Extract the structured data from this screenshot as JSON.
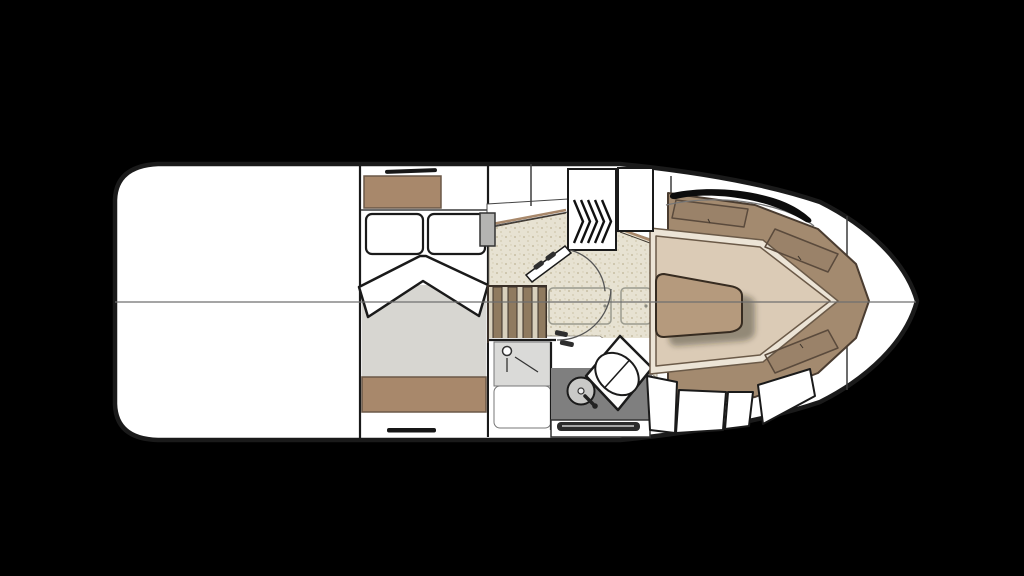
{
  "page": {
    "background": "#000000"
  },
  "palette": {
    "bg": "#000000",
    "paper": "#ffffff",
    "ink": "#1a1a1a",
    "wood": "#a8886b",
    "bed": "#d7d6d1",
    "floor": "#e7e2d2",
    "floorDot": "#c7bfa4",
    "stairLight": "#d8d0bc",
    "stairDark": "#8f7a5f",
    "shower": "#dadad8",
    "counter": "#7f7f7f",
    "sink": "#c9c9c7",
    "backrest": "#a38a6f",
    "seatEdge": "#ece4d6",
    "cushion": "#dbcbb6",
    "table": "#b59a7d",
    "centerline": "#6f6f6f"
  },
  "plan": {
    "labels": {
      "hull": "boat hull outline, top-down floor plan",
      "aftDeck": "aft cockpit deck (open area)",
      "centerline": "hull centerline",
      "cabin": "owner's cabin with double berth",
      "wardrobeTop": "cabin storage locker (port)",
      "wardrobeBottom": "cabin storage locker (starboard)",
      "pillows": "berth pillows",
      "blanket": "folded v-blanket on berth",
      "hatchTop": "flush deck hatch handle",
      "hatchBottom": "flush deck hatch handle",
      "mirror": "bulkhead-mounted mirror",
      "companionway": "companionway hatch with tread chevrons",
      "steps": "companionway steps",
      "galley": "galley and passage floor",
      "counterTrim": "galley counter edge trim",
      "floorHatches": "cabin sole access hatches",
      "cabinDoor": "cabin entry door with swing arc",
      "headDoor": "head compartment door swing arc",
      "head": "wet head compartment",
      "shower": "shower stall with drain",
      "vanity": "vanity counter",
      "sink": "round washbasin with faucet",
      "toilet": "marine toilet on angled platform",
      "towelSlot": "vanity cabinet with towel recess",
      "bowLounge": "bow lounge seating area",
      "backrests": "upholstered backrest cushions",
      "seatPanels": "backrest stitch panels",
      "table": "bow lounge table",
      "lockers": "under-seat stowage lockers",
      "bowRail": "bow grab rail",
      "foredeckSeam": "foredeck bulkhead seam"
    }
  }
}
